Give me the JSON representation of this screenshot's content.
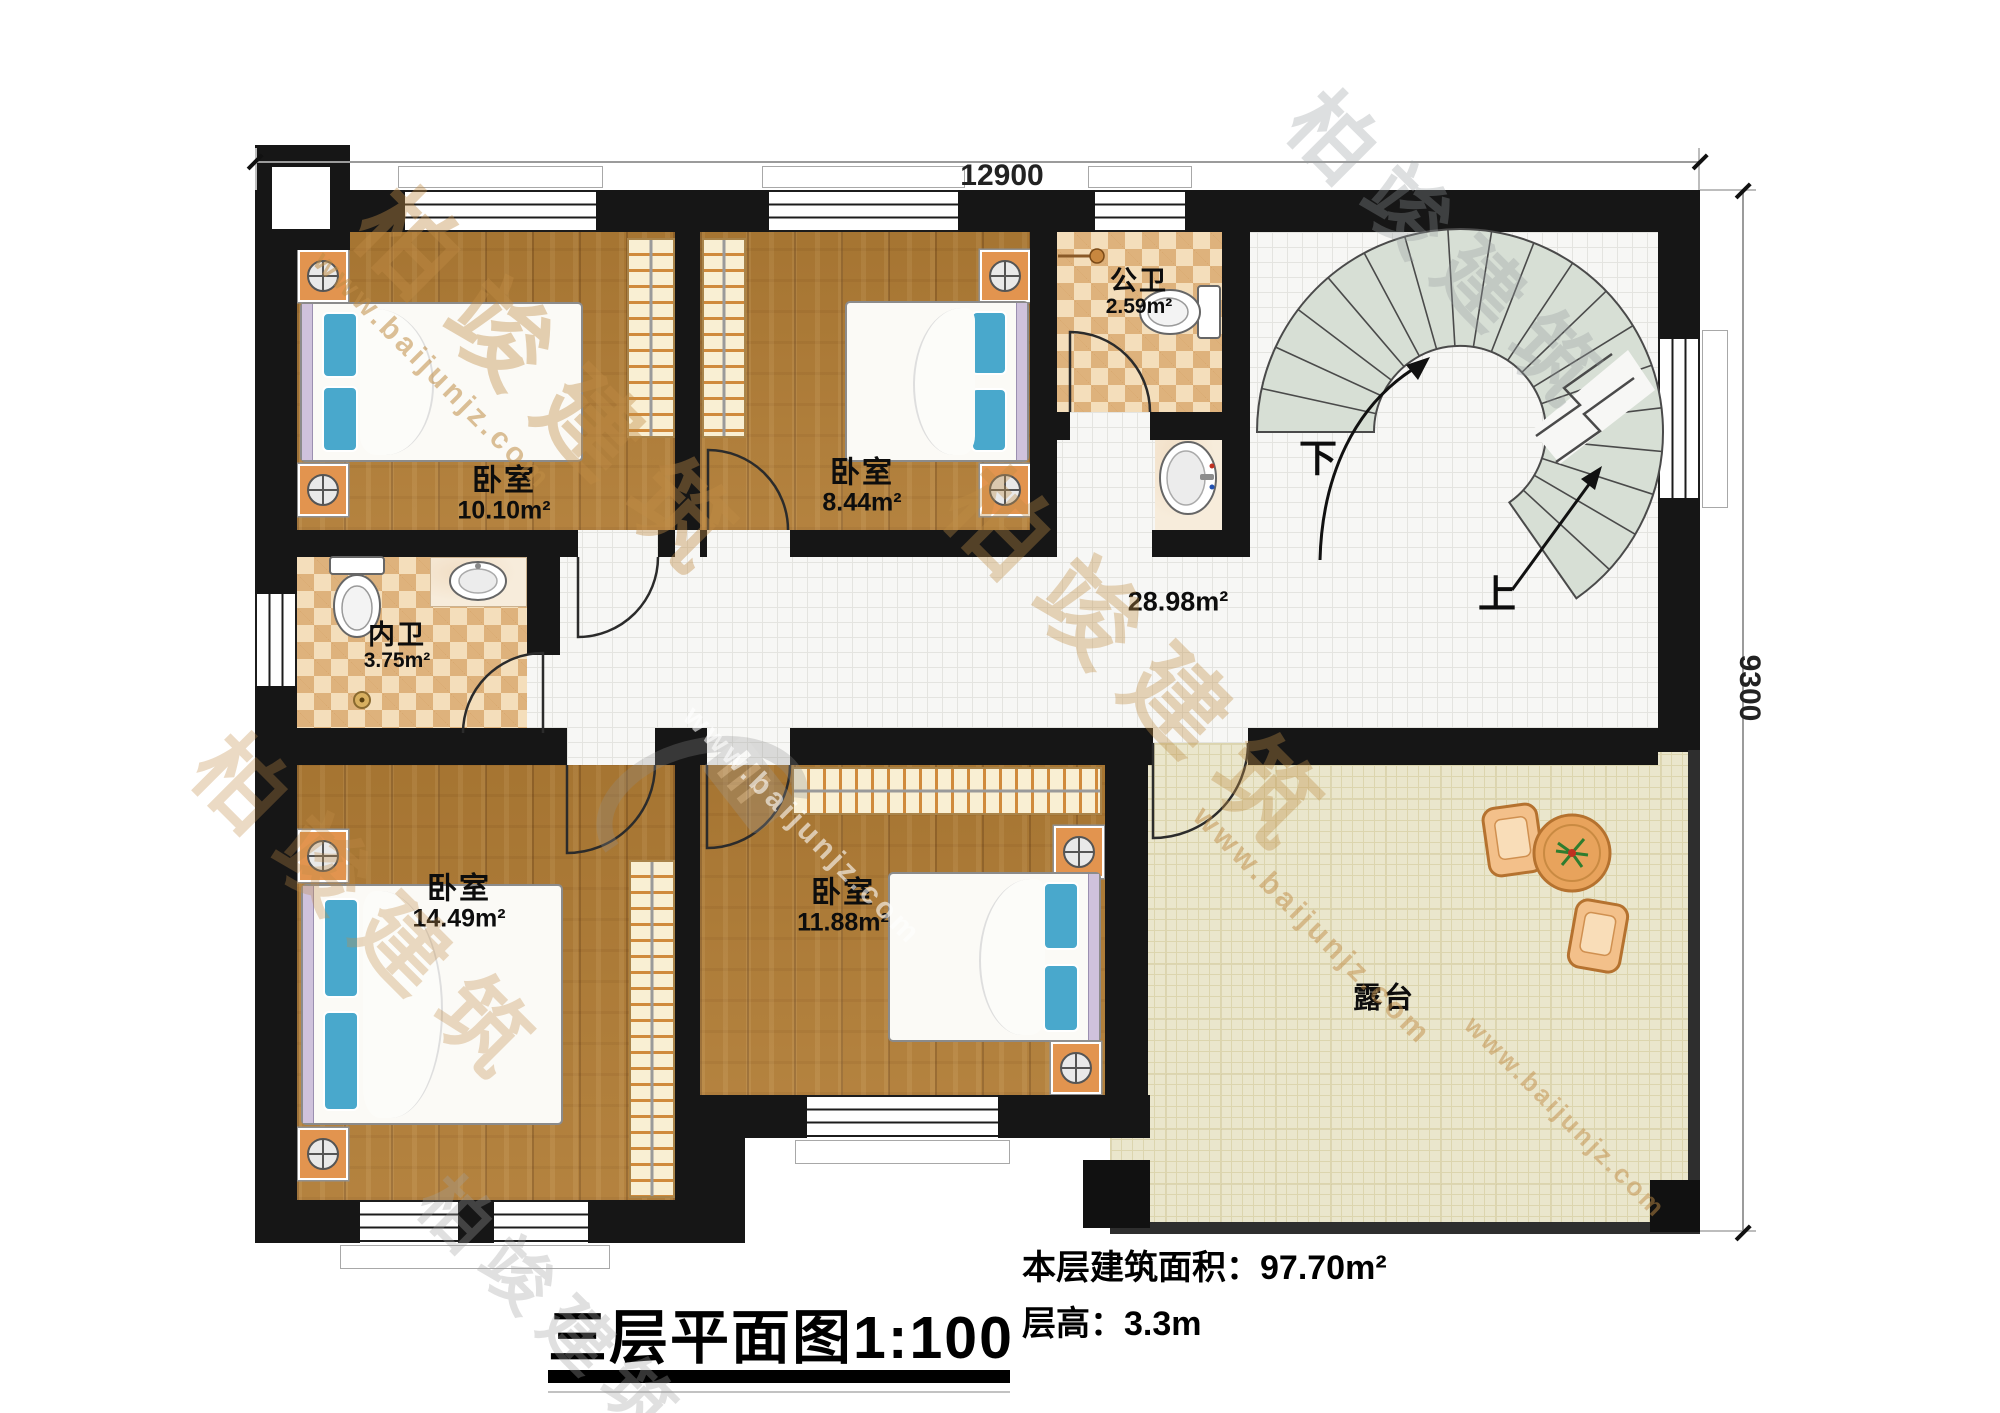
{
  "dimensions": {
    "top": "12900",
    "right": "9300"
  },
  "rooms": [
    {
      "id": "bedroom-top-left",
      "name": "卧室",
      "area": "10.10m²"
    },
    {
      "id": "bedroom-top-middle",
      "name": "卧室",
      "area": "8.44m²"
    },
    {
      "id": "public-bathroom",
      "name": "公卫",
      "area": "2.59m²"
    },
    {
      "id": "inner-bathroom",
      "name": "内卫",
      "area": "3.75m²"
    },
    {
      "id": "hallway",
      "name": "",
      "area": "28.98m²"
    },
    {
      "id": "bedroom-bottom-left",
      "name": "卧室",
      "area": "14.49m²"
    },
    {
      "id": "bedroom-bottom-mid",
      "name": "卧室",
      "area": "11.88m²"
    },
    {
      "id": "terrace",
      "name": "露台",
      "area": ""
    }
  ],
  "stairs": {
    "down": "下",
    "up": "上"
  },
  "title_block": {
    "floor_title": "三层平面图",
    "scale": "1:100",
    "area_label": "本层建筑面积：",
    "area_value": "97.70m²",
    "height_label": "层高：",
    "height_value": "3.3m"
  },
  "watermark": {
    "brand": "柏竣建筑",
    "url": "www.baijunjz.com"
  }
}
